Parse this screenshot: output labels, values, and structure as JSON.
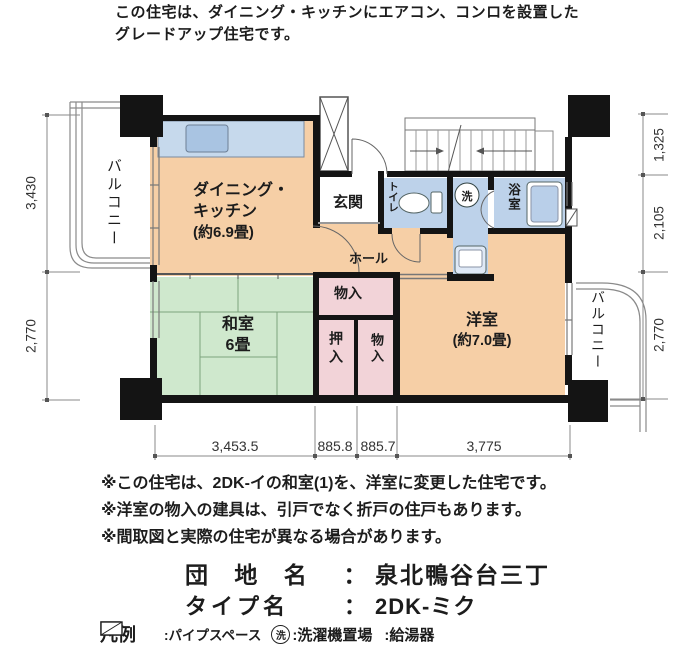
{
  "header": {
    "line1": "この住宅は、ダイニング・キッチンにエアコン、コンロを設置した",
    "line2": "グレードアップ住宅です。"
  },
  "plan": {
    "rooms": {
      "balcony_left": "バルコニー",
      "dk_line1": "ダイニング・",
      "dk_line2": "キッチン",
      "dk_line3": "(約6.9畳)",
      "genkan": "玄関",
      "toilet": "トイレ",
      "wash_symbol": "洗",
      "bath": "浴室",
      "hall": "ホール",
      "monoire_upper": "物入",
      "washitsu_line1": "和室",
      "washitsu_line2": "6畳",
      "oshiire": "押入",
      "monoire_lower": "物入",
      "yoshitsu_line1": "洋室",
      "yoshitsu_line2": "(約7.0畳)",
      "balcony_right": "バルコニー"
    },
    "dimensions": {
      "left": [
        "3,430",
        "2,770"
      ],
      "right": [
        "1,325",
        "2,105",
        "2,770"
      ],
      "bottom": [
        "3,453.5",
        "885.8",
        "885.7",
        "3,775"
      ]
    }
  },
  "notes": [
    "※この住宅は、2DK-イの和室(1)を、洋室に変更した住宅です。",
    "※洋室の物入の建具は、引戸でなく折戸の住戸もあります。",
    "※間取図と実際の住宅が異なる場合があります。"
  ],
  "estate": {
    "name_label": "団 地 名",
    "name_colon": "：",
    "name_value": "泉北鴨谷台三丁",
    "type_label": "タイプ名",
    "type_colon": "：",
    "type_value": "2DK-ミク"
  },
  "legend": {
    "title": "凡例",
    "pipe_label": ":パイプスペース",
    "washer_symbol": "洗",
    "washer_label": ":洗濯機置場",
    "heater_label": ":給湯器"
  },
  "colors": {
    "room_salmon": "#f6cfa6",
    "tatami_green": "#cfe8cd",
    "water_blue": "#bdd2ea",
    "closet_pink": "#f2d3d8",
    "wall_black": "#141414"
  }
}
